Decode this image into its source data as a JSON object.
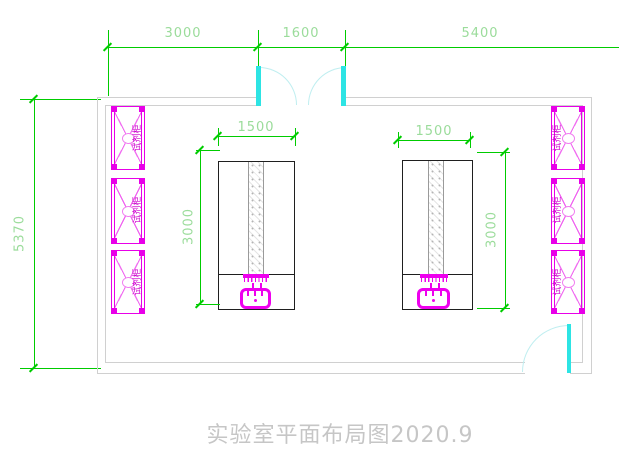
{
  "title": {
    "text": "实验室平面布局图2020.9"
  },
  "dimensions": {
    "top": {
      "seg1": "3000",
      "seg2": "1600",
      "seg3": "5400"
    },
    "left": {
      "overall": "5370"
    },
    "left_table": {
      "width": "1500",
      "depth": "3000"
    },
    "right_table": {
      "width": "1500",
      "depth": "3000"
    }
  },
  "cabinets": {
    "left": [
      {
        "label": "试剂柜"
      },
      {
        "label": "试剂柜"
      },
      {
        "label": "试剂柜"
      }
    ],
    "right": [
      {
        "label": "试剂柜"
      },
      {
        "label": "试剂柜"
      },
      {
        "label": "试剂柜"
      }
    ]
  },
  "colors": {
    "dim_line": "#00cc00",
    "dim_text": "#9bdc9b",
    "cabinet_line": "#e800e8",
    "cabinet_text": "#cc00cc",
    "door_leaf": "#2de4e4",
    "door_arc": "#bfeef0",
    "wall_line": "#d0d0d0",
    "table_line": "#1f1f1f",
    "sink": "#ee00ee",
    "title_text": "#c6c6c6"
  }
}
